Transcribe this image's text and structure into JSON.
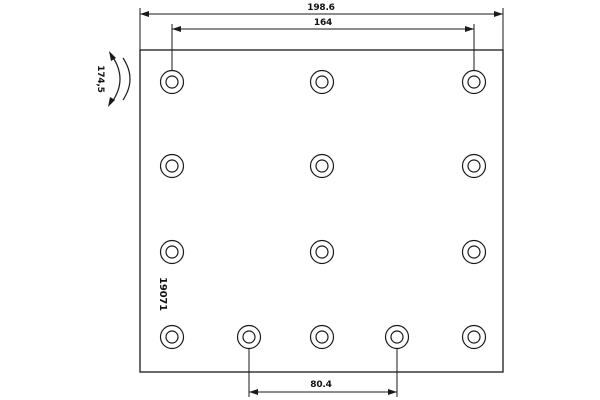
{
  "drawing": {
    "type": "brake-lining-technical-drawing",
    "part_number": "19071",
    "dimensions": {
      "total_width": "198.6",
      "top_hole_span": "164",
      "bottom_hole_span": "80.4",
      "radius": "174,5"
    },
    "colors": {
      "line": "#1a1a1a",
      "background": "#ffffff"
    },
    "plate": {
      "x": 140,
      "y": 50,
      "width": 363,
      "height": 322
    },
    "holes": {
      "outer_radius": 11.5,
      "inner_radius": 6,
      "rows": [
        {
          "y": 82,
          "x": [
            172,
            322,
            474
          ]
        },
        {
          "y": 166,
          "x": [
            172,
            322,
            474
          ]
        },
        {
          "y": 252,
          "x": [
            172,
            322,
            474
          ]
        },
        {
          "y": 337,
          "x": [
            172,
            249,
            322,
            397,
            474
          ]
        }
      ]
    }
  }
}
